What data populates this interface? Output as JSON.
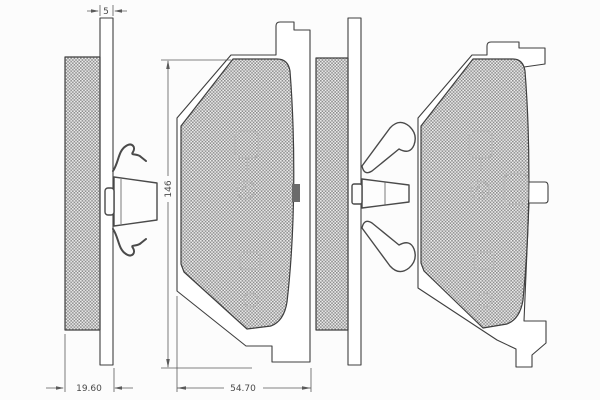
{
  "dimensions": {
    "plate_thickness": "5",
    "total_thickness": "19.60",
    "pad_length": "146",
    "pad_width": "54.70"
  },
  "colors": {
    "background": "#fcfcfc",
    "line": "#3f3f3f",
    "hatch_dark": "#8d8d8d",
    "hatch_light": "#efefef"
  },
  "views": {
    "edge_view_left": "brake-pad-side-profile-with-spring-clip",
    "front_view_left": "brake-pad-front-view",
    "edge_view_right": "brake-pad-side-profile-with-chevron-clip",
    "front_view_right": "brake-pad-front-view-with-side-lug"
  }
}
